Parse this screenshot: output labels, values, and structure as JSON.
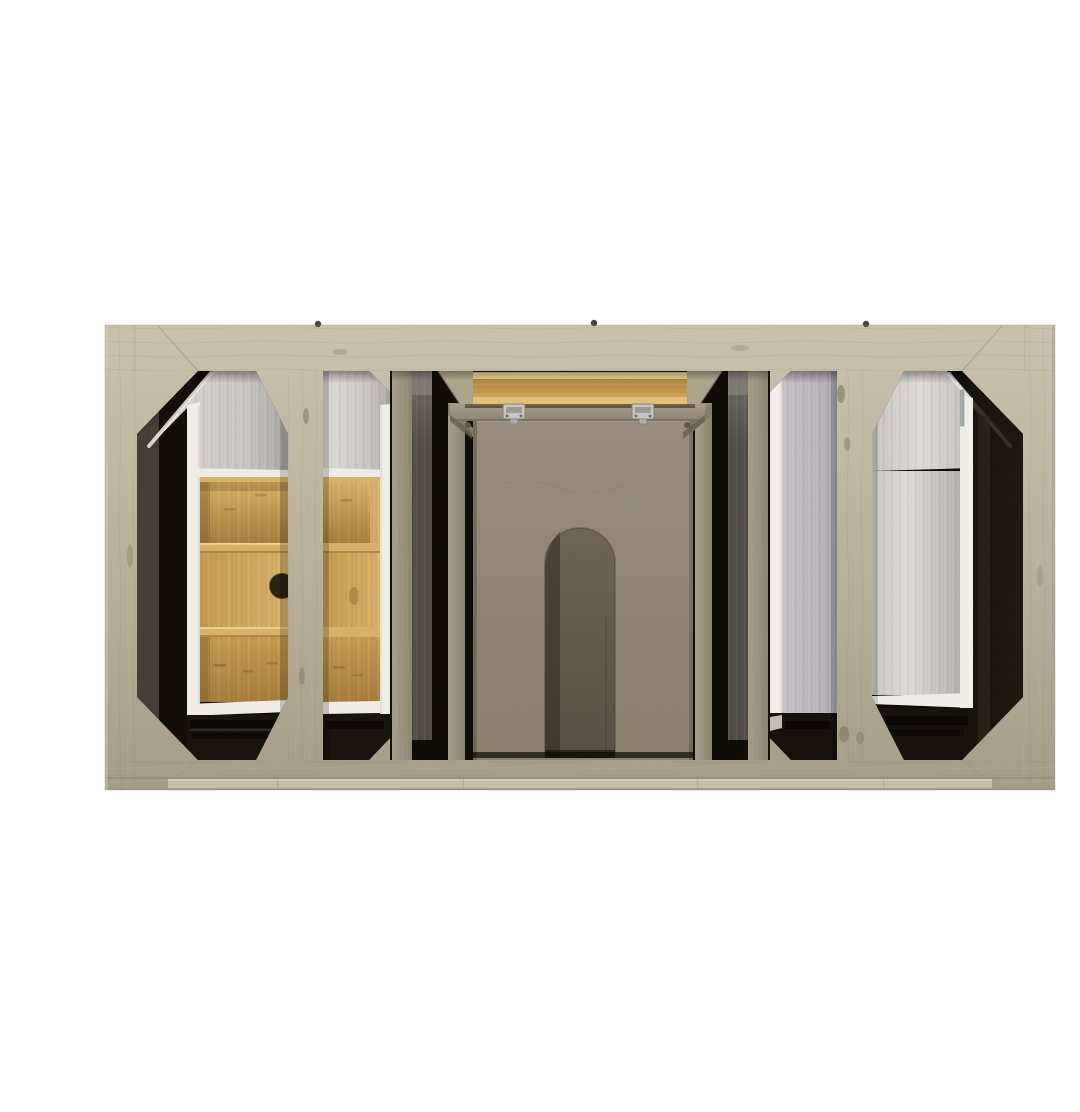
{
  "scene": {
    "type": "product-photograph",
    "description": "Back view of a light gray-washed solid wood bathroom vanity cabinet on a plain white background, revealing internal white drawer boxes, a three-tier bamboo drawer organizer, an open bamboo drawer with metal latches, gray support posts and a taupe panel with an arched plumbing cutout, framed by octagonal and narrow cutouts in the back frame."
  },
  "palette": {
    "bg": "#ffffff",
    "frameLight": "#cac2ab",
    "frame": "#b9b09a",
    "frameDark": "#a69d86",
    "frameEdge": "#978e76",
    "lip": "#c6bda6",
    "interiorDark": "#3a3127",
    "interiorBlack": "#0d0a06",
    "postGray": "#a89f8b",
    "postGrayDark": "#8c8370",
    "metalLight": "#6e6a62",
    "metalDark": "#4f4b44",
    "taupeLight": "#988d7c",
    "taupe": "#8a7f6d",
    "archLight": "#6e6454",
    "archDark": "#574e41",
    "silverLight": "#dedcd9",
    "silver": "#c7c5c3",
    "silverDark": "#a9a7a5",
    "silverCool": "#c6c3c8",
    "silverCoolDark": "#aeabb2",
    "whiteEdge": "#f1efe9",
    "whiteDim": "#d8d4ca",
    "bambooEdge": "#ecd194",
    "bambooLight": "#dab269",
    "bamboo": "#c89a4f",
    "bambooDark": "#a87c3c",
    "bambooShadow": "#7c5c26",
    "latch": "#c8c8c6",
    "latchDark": "#7e7e7c",
    "screw": "#46423c"
  },
  "parts": {
    "photo": "Back view of a light gray washed wood bathroom vanity cabinet",
    "frame": "Weathered greige wood back frame",
    "left_octagon_window": "Left octagonal cutout revealing dark interior, white drawer box edge and bamboo organizer",
    "left_narrow_window": "Left narrow cutout showing bamboo organizer and white drawer box wall",
    "center_window": "Center opening with bamboo drawer, metal latches, support posts and arched plumbing panel",
    "right_narrow_window": "Right narrow cutout showing brushed drawer box side panel",
    "right_octagon_window": "Right octagonal cutout revealing white drawer box and dark interior",
    "bamboo_drawer": "Open bamboo drawer box seen edge-on",
    "drawer_latch": "Metal drawer latch clip",
    "bamboo_organizer": "Three-tier bamboo drawer organizer with finger hole",
    "arch_panel": "Taupe plywood panel with arched plumbing cutout",
    "silver_panel": "Brushed metallic drawer box panel",
    "white_edge": "White painted drawer box edge",
    "support_post": "Gray interior support post",
    "top_rail": "Top rail of back frame",
    "bottom_rail": "Bottom rail of back frame with recessed lip",
    "wood_knot": "Dark wood grain knot",
    "back_screw": "Screw head on top edge"
  }
}
